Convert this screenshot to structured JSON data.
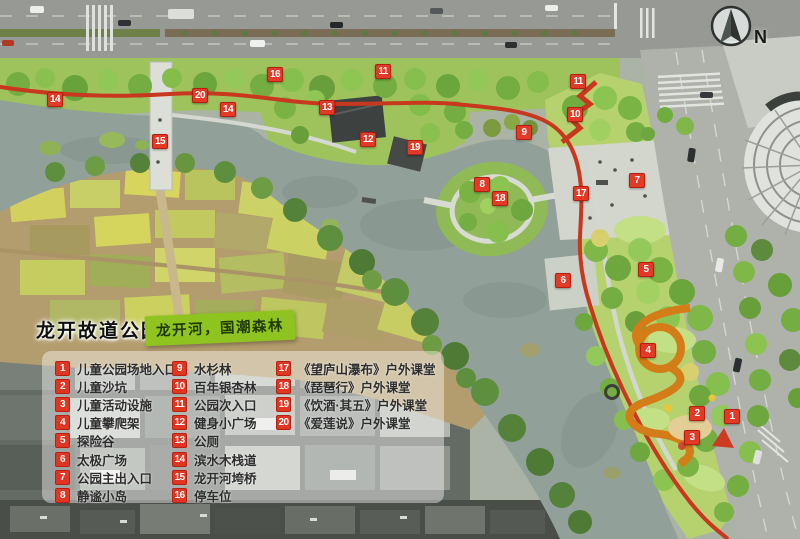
{
  "header": {
    "park_name": "龙开故道公园",
    "slogan": "龙开河，国潮森林"
  },
  "compass": {
    "label": "N"
  },
  "legend": {
    "items": [
      {
        "num": "1",
        "label": "儿童公园场地入口"
      },
      {
        "num": "2",
        "label": "儿童沙坑"
      },
      {
        "num": "3",
        "label": "儿童活动设施"
      },
      {
        "num": "4",
        "label": "儿童攀爬架"
      },
      {
        "num": "5",
        "label": "探险谷"
      },
      {
        "num": "6",
        "label": "太极广场"
      },
      {
        "num": "7",
        "label": "公园主出入口"
      },
      {
        "num": "8",
        "label": "静谧小岛"
      },
      {
        "num": "9",
        "label": "水杉林"
      },
      {
        "num": "10",
        "label": "百年银杏林"
      },
      {
        "num": "11",
        "label": "公园次入口"
      },
      {
        "num": "12",
        "label": "健身小广场"
      },
      {
        "num": "13",
        "label": "公厕"
      },
      {
        "num": "14",
        "label": "滨水木栈道"
      },
      {
        "num": "15",
        "label": "龙开河垮桥"
      },
      {
        "num": "16",
        "label": "停车位"
      },
      {
        "num": "17",
        "label": "《望庐山瀑布》户外课堂"
      },
      {
        "num": "18",
        "label": "《琵琶行》户外课堂"
      },
      {
        "num": "19",
        "label": "《饮酒·其五》户外课堂"
      },
      {
        "num": "20",
        "label": "《爱莲说》户外课堂"
      }
    ]
  },
  "map": {
    "markers": [
      {
        "n": "14",
        "x": 55,
        "y": 100
      },
      {
        "n": "20",
        "x": 200,
        "y": 96
      },
      {
        "n": "14",
        "x": 228,
        "y": 110
      },
      {
        "n": "15",
        "x": 160,
        "y": 142
      },
      {
        "n": "16",
        "x": 275,
        "y": 75
      },
      {
        "n": "11",
        "x": 383,
        "y": 72
      },
      {
        "n": "13",
        "x": 327,
        "y": 108
      },
      {
        "n": "12",
        "x": 368,
        "y": 140
      },
      {
        "n": "19",
        "x": 415,
        "y": 148
      },
      {
        "n": "11",
        "x": 578,
        "y": 82
      },
      {
        "n": "10",
        "x": 575,
        "y": 115
      },
      {
        "n": "9",
        "x": 524,
        "y": 133
      },
      {
        "n": "8",
        "x": 482,
        "y": 185
      },
      {
        "n": "18",
        "x": 500,
        "y": 199
      },
      {
        "n": "17",
        "x": 581,
        "y": 194
      },
      {
        "n": "7",
        "x": 637,
        "y": 181
      },
      {
        "n": "6",
        "x": 563,
        "y": 281
      },
      {
        "n": "5",
        "x": 646,
        "y": 270
      },
      {
        "n": "4",
        "x": 648,
        "y": 351
      },
      {
        "n": "2",
        "x": 697,
        "y": 414
      },
      {
        "n": "1",
        "x": 732,
        "y": 417
      },
      {
        "n": "3",
        "x": 692,
        "y": 438
      }
    ]
  },
  "colors": {
    "marker_red": "#e23a26",
    "slogan_green": "#8fc320",
    "water": "#91a19a",
    "trail_red": "#c8381f"
  }
}
